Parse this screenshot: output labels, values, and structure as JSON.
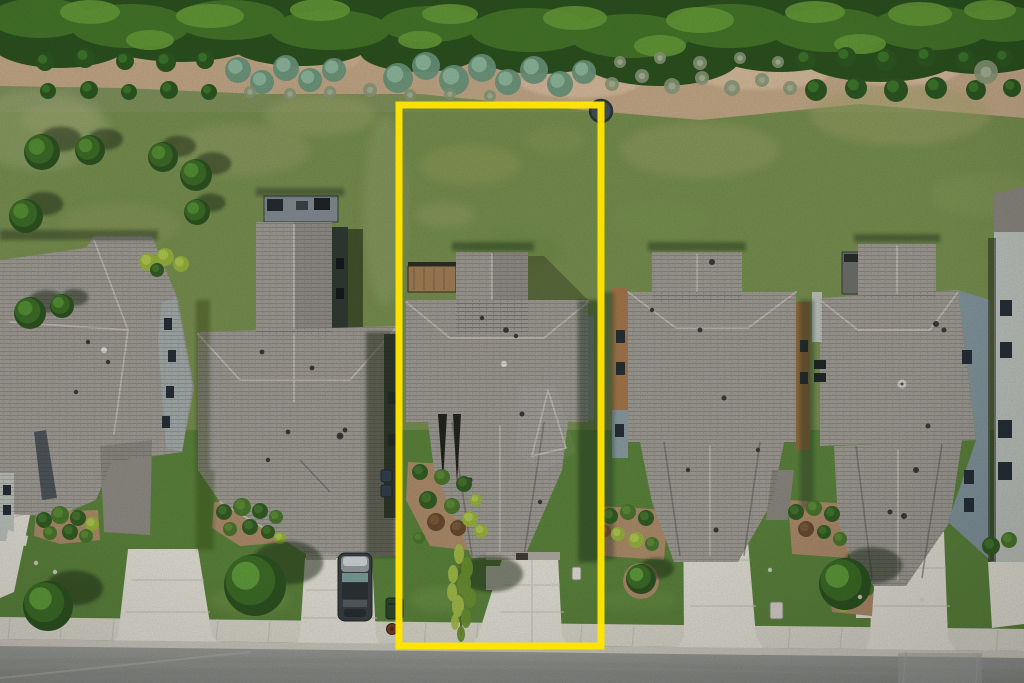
{
  "meta": {
    "type": "aerial-photograph",
    "subject": "Overhead drone photo of a suburban street: row of five gray-shingle-roof houses, green lawns, concrete driveways, sidewalk and asphalt street at bottom, wooded tree line with dirt planting strip at top. The center lot is outlined with a bright yellow property-boundary rectangle.",
    "image_size": {
      "width": 1024,
      "height": 683
    }
  },
  "palette": {
    "boundary": "#ffe400",
    "treeDark": "#2d5420",
    "tree": "#47792b",
    "treeLight": "#6aa03a",
    "dirt": "#c9ad8b",
    "dirtLight": "#e3c7a8",
    "grassBack": "#7b9452",
    "grassFront": "#5e873e",
    "roof": "#a6a29b",
    "roofDark": "#938f88",
    "ridge": "#d0cbc2",
    "valley": "#64615b",
    "concrete": "#eae7dc",
    "sidewalk": "#e0ddd1",
    "curb": "#d3d0c5",
    "asphalt": "#9a9c98",
    "mulch": "#b2906e",
    "shadow": "#1d2b12",
    "wallGray": "#aab4b2",
    "wallBlue": "#8fa0a8",
    "wallTan": "#a97c4f",
    "wallLight": "#c4c9c3"
  },
  "boundary": {
    "x": 399,
    "y": 105,
    "width": 202,
    "height": 541,
    "stroke_width": 7
  },
  "vegetation": {
    "top_shrubs": [
      [
        45,
        62,
        9
      ],
      [
        85,
        58,
        10
      ],
      [
        125,
        61,
        9
      ],
      [
        166,
        62,
        10
      ],
      [
        205,
        60,
        9
      ],
      [
        48,
        91,
        8
      ],
      [
        89,
        90,
        9
      ],
      [
        129,
        92,
        8
      ],
      [
        169,
        90,
        9
      ],
      [
        209,
        92,
        8
      ],
      [
        806,
        60,
        10
      ],
      [
        846,
        57,
        10
      ],
      [
        886,
        60,
        11
      ],
      [
        926,
        57,
        10
      ],
      [
        966,
        60,
        10
      ],
      [
        1004,
        58,
        9
      ],
      [
        816,
        90,
        11
      ],
      [
        856,
        88,
        11
      ],
      [
        896,
        90,
        12
      ],
      [
        936,
        88,
        11
      ],
      [
        976,
        90,
        10
      ],
      [
        1012,
        88,
        9
      ]
    ],
    "teal_plants": [
      [
        238,
        70,
        13
      ],
      [
        262,
        82,
        12
      ],
      [
        286,
        68,
        13
      ],
      [
        310,
        80,
        12
      ],
      [
        334,
        70,
        12
      ],
      [
        398,
        78,
        15
      ],
      [
        426,
        66,
        14
      ],
      [
        454,
        80,
        15
      ],
      [
        482,
        68,
        14
      ],
      [
        508,
        82,
        13
      ],
      [
        534,
        70,
        14
      ],
      [
        560,
        84,
        13
      ],
      [
        584,
        72,
        12
      ]
    ],
    "grass_tufts": [
      [
        250,
        92,
        6
      ],
      [
        290,
        94,
        6
      ],
      [
        330,
        92,
        6
      ],
      [
        370,
        90,
        7
      ],
      [
        410,
        95,
        6
      ],
      [
        450,
        94,
        6
      ],
      [
        490,
        96,
        6
      ],
      [
        612,
        84,
        7
      ],
      [
        642,
        76,
        7
      ],
      [
        672,
        86,
        8
      ],
      [
        702,
        78,
        7
      ],
      [
        732,
        88,
        8
      ],
      [
        762,
        80,
        7
      ],
      [
        790,
        88,
        7
      ],
      [
        620,
        62,
        6
      ],
      [
        660,
        58,
        6
      ],
      [
        700,
        63,
        7
      ],
      [
        740,
        58,
        6
      ],
      [
        778,
        62,
        6
      ],
      [
        986,
        72,
        12
      ]
    ],
    "backyard_trees": [
      [
        42,
        152,
        18
      ],
      [
        90,
        150,
        15
      ],
      [
        163,
        157,
        15
      ],
      [
        196,
        175,
        16
      ],
      [
        197,
        212,
        13
      ],
      [
        26,
        216,
        17
      ],
      [
        30,
        313,
        16
      ],
      [
        62,
        306,
        12
      ]
    ],
    "front_trees": [
      [
        48,
        606,
        25
      ],
      [
        255,
        585,
        31
      ],
      [
        845,
        584,
        26
      ],
      [
        641,
        579,
        15
      ]
    ],
    "center_tree": {
      "x": 461,
      "y": 588
    },
    "bushes": [
      [
        44,
        520,
        8,
        "dark"
      ],
      [
        60,
        515,
        9,
        "bush"
      ],
      [
        78,
        518,
        8,
        "dark"
      ],
      [
        92,
        524,
        7,
        "light"
      ],
      [
        50,
        533,
        7,
        "bush"
      ],
      [
        70,
        532,
        8,
        "dark"
      ],
      [
        86,
        536,
        7,
        "bush"
      ],
      [
        224,
        512,
        8,
        "dark"
      ],
      [
        242,
        507,
        9,
        "bush"
      ],
      [
        260,
        511,
        8,
        "dark"
      ],
      [
        276,
        517,
        7,
        "bush"
      ],
      [
        230,
        529,
        7,
        "bush"
      ],
      [
        250,
        527,
        8,
        "dark"
      ],
      [
        268,
        532,
        7,
        "dark"
      ],
      [
        280,
        538,
        6,
        "light"
      ],
      [
        420,
        472,
        8,
        "dark"
      ],
      [
        442,
        477,
        8,
        "bush"
      ],
      [
        464,
        484,
        8,
        "dark"
      ],
      [
        428,
        500,
        9,
        "dark"
      ],
      [
        452,
        506,
        8,
        "bush"
      ],
      [
        436,
        522,
        9,
        "mound"
      ],
      [
        458,
        528,
        8,
        "mound"
      ],
      [
        470,
        519,
        8,
        "light"
      ],
      [
        481,
        531,
        7,
        "light"
      ],
      [
        476,
        500,
        6,
        "light"
      ],
      [
        419,
        538,
        6,
        "bush"
      ],
      [
        610,
        516,
        8,
        "dark"
      ],
      [
        628,
        512,
        8,
        "bush"
      ],
      [
        646,
        518,
        8,
        "dark"
      ],
      [
        618,
        534,
        7,
        "light"
      ],
      [
        636,
        540,
        8,
        "light"
      ],
      [
        652,
        544,
        7,
        "bush"
      ],
      [
        605,
        531,
        6,
        "mound"
      ],
      [
        796,
        512,
        8,
        "dark"
      ],
      [
        814,
        508,
        8,
        "bush"
      ],
      [
        832,
        514,
        8,
        "dark"
      ],
      [
        806,
        529,
        8,
        "mound"
      ],
      [
        824,
        532,
        7,
        "dark"
      ],
      [
        840,
        539,
        7,
        "bush"
      ],
      [
        836,
        591,
        9,
        "dark"
      ],
      [
        852,
        597,
        8,
        "dark"
      ],
      [
        867,
        589,
        7,
        "bush"
      ],
      [
        843,
        605,
        7,
        "light"
      ],
      [
        991,
        546,
        9,
        "dark"
      ],
      [
        1009,
        540,
        8,
        "bush"
      ],
      [
        148,
        262,
        9,
        "light"
      ],
      [
        165,
        257,
        9,
        "light"
      ],
      [
        181,
        264,
        8,
        "light"
      ],
      [
        157,
        270,
        7,
        "dark"
      ]
    ]
  },
  "objects": {
    "car": {
      "x": 338,
      "y": 553,
      "width": 34,
      "height": 68,
      "body": "#3c4146",
      "roof": "#2e3437",
      "hood": "#9aa2a6",
      "windshield": "#7fa3a0",
      "glare": "#dde2e2"
    },
    "trash_bin": {
      "x": 386,
      "y": 598,
      "width": 17,
      "height": 21,
      "color": "#2e4a30"
    },
    "valve_cover": {
      "x": 392,
      "y": 629,
      "r": 5.5,
      "color": "#7a3f30"
    },
    "utility_disc": {
      "x": 601,
      "y": 111,
      "r": 11,
      "color": "#46525c",
      "rim": "#2e383f"
    },
    "mailbox_center": {
      "x": 572,
      "y": 567,
      "w": 9,
      "h": 13,
      "color": "#e6e3da"
    },
    "mailbox_right": {
      "x": 770,
      "y": 602,
      "w": 13,
      "h": 17,
      "color": "#dcd9cf"
    },
    "utility_pads": [
      [
        381,
        470,
        11,
        12
      ],
      [
        381,
        485,
        11,
        12
      ]
    ],
    "lawn_markers": [
      [
        36,
        563
      ],
      [
        55,
        572
      ],
      [
        553,
        585
      ],
      [
        860,
        597
      ],
      [
        922,
        600
      ],
      [
        770,
        570
      ]
    ]
  },
  "hardscape": {
    "sidewalk_joints_x": [
      10,
      62,
      114,
      166,
      218,
      270,
      322,
      374,
      426,
      478,
      530,
      582,
      634,
      686,
      738,
      790,
      842,
      894,
      946,
      998
    ]
  }
}
